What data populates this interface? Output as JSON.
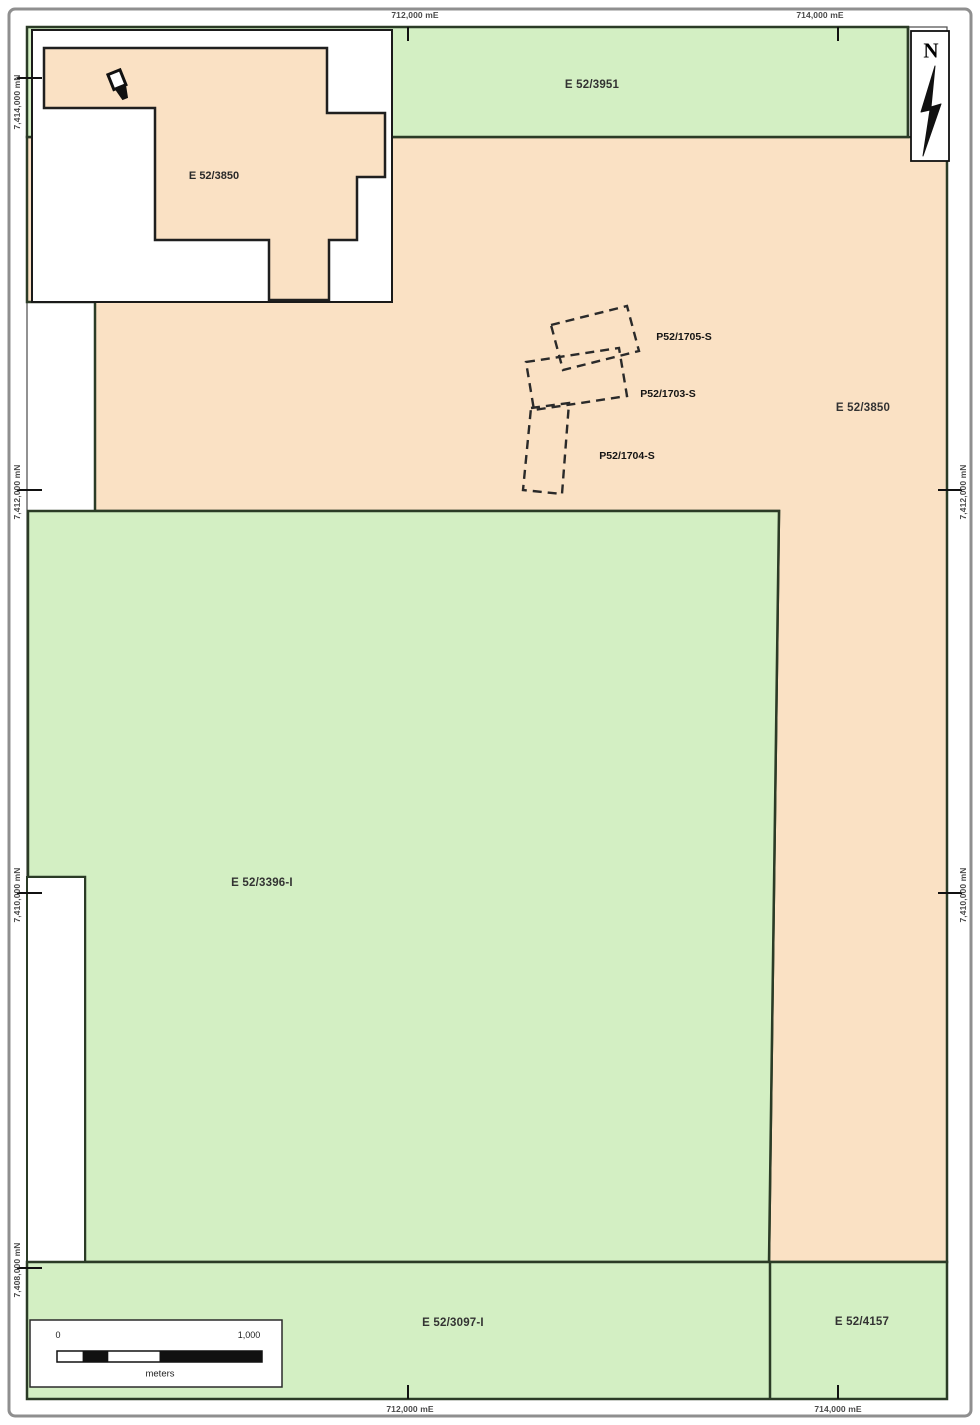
{
  "areas": {
    "e3951": "E 52/3951",
    "e3850": "E 52/3850",
    "e3396": "E 52/3396-I",
    "e3097": "E 52/3097-I",
    "e4157": "E 52/4157",
    "inset": "E 52/3850"
  },
  "prospects": {
    "p1705": "P52/1705-S",
    "p1703": "P52/1703-S",
    "p1704": "P52/1704-S"
  },
  "north": {
    "label": "N"
  },
  "scalebar": {
    "zero": "0",
    "max": "1,000",
    "unit": "meters"
  },
  "coordinates": {
    "top": [
      "712,000 mE",
      "714,000 mE"
    ],
    "bottom": [
      "712,000 mE",
      "714,000 mE"
    ],
    "left": [
      "7,414,000 mN",
      "7,412,000 mN",
      "7,410,000 mN",
      "7,408,000 mN"
    ],
    "right": [
      "7,412,000 mN",
      "7,410,000 mN"
    ]
  },
  "colors": {
    "peach_fill": "#FAE1C4",
    "green_fill": "#D3EFC3",
    "boundary": "#2B3B26"
  }
}
